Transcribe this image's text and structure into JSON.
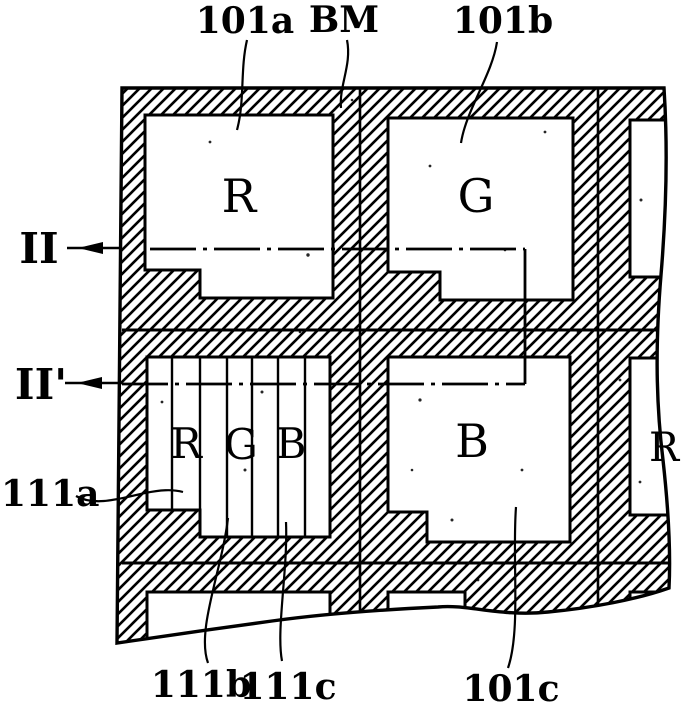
{
  "page": {
    "background_color": "#ffffff",
    "ink_color": "#000000"
  },
  "figure": {
    "reference_labels": {
      "top_left": "101a",
      "top_middle": "BM",
      "top_right": "101b",
      "section_left": "II",
      "section_left_prime": "II'",
      "left_lower": "111a",
      "bottom_first": "111b",
      "bottom_second": "111c",
      "bottom_right": "101c"
    },
    "pixel_letters": {
      "top_left_pixel": "R",
      "top_right_pixel": "G",
      "lower_right_pixel": "B",
      "stripe_pixel": [
        "R",
        "G",
        "B"
      ],
      "edge_pixel": "R"
    }
  }
}
